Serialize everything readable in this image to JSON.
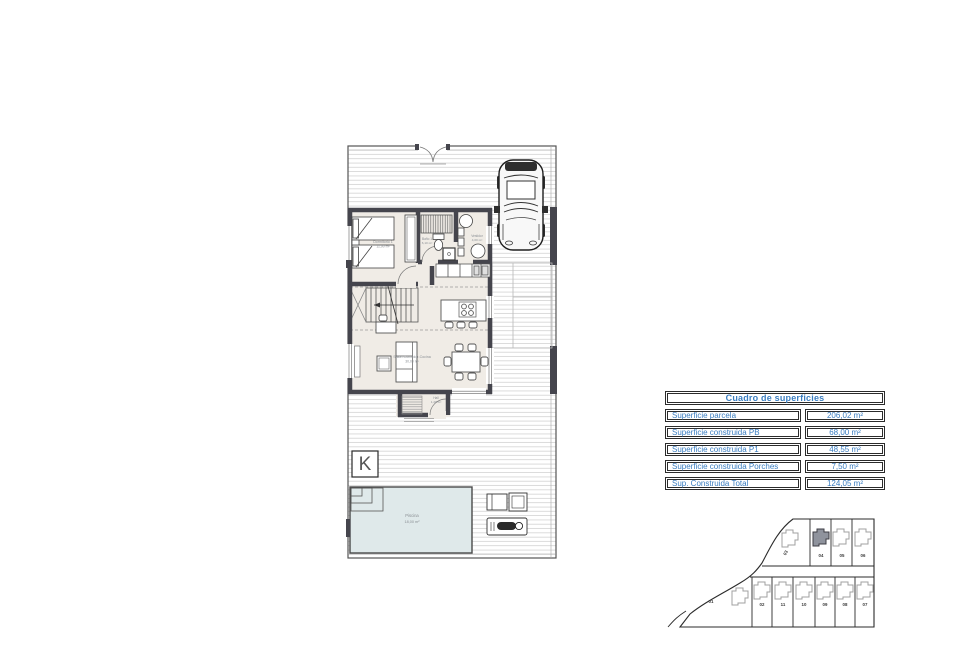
{
  "surfaces_table": {
    "title": "Cuadro de superficies",
    "accent_color": "#3a7dc0",
    "rows": [
      {
        "label": "Superficie parcela",
        "value": "206,02 m²"
      },
      {
        "label": "Superficie construida PB",
        "value": "68,00 m²"
      },
      {
        "label": "Superficie construida P1",
        "value": "48,55 m²"
      },
      {
        "label": "Superficie construida Porches",
        "value": "7,50 m²"
      },
      {
        "label": "Sup. Construida Total",
        "value": "124,05 m²"
      }
    ]
  },
  "floor_plan": {
    "labels": {
      "bedroom_name": "Dormitorio 1",
      "bedroom_area": "11,90 m²",
      "bath_name": "Baño 1",
      "bath_area": "6,10 m²",
      "dressing_name": "Vestidor",
      "dressing_area": "4,00 m²",
      "living_name": "Salón-Comedor-Cocina",
      "living_area": "30,00 m²",
      "hall_name": "Hall",
      "hall_area": "1,20 m²",
      "pool_name": "Piscina",
      "pool_area": "18,00 m²"
    },
    "north_marker": "K"
  },
  "site_plan": {
    "highlighted_plot": "04",
    "plots": [
      {
        "label": "01"
      },
      {
        "label": "02"
      },
      {
        "label": "03"
      },
      {
        "label": "04"
      },
      {
        "label": "05"
      },
      {
        "label": "06"
      },
      {
        "label": "07"
      },
      {
        "label": "08"
      },
      {
        "label": "09"
      },
      {
        "label": "10"
      },
      {
        "label": "11"
      }
    ]
  }
}
